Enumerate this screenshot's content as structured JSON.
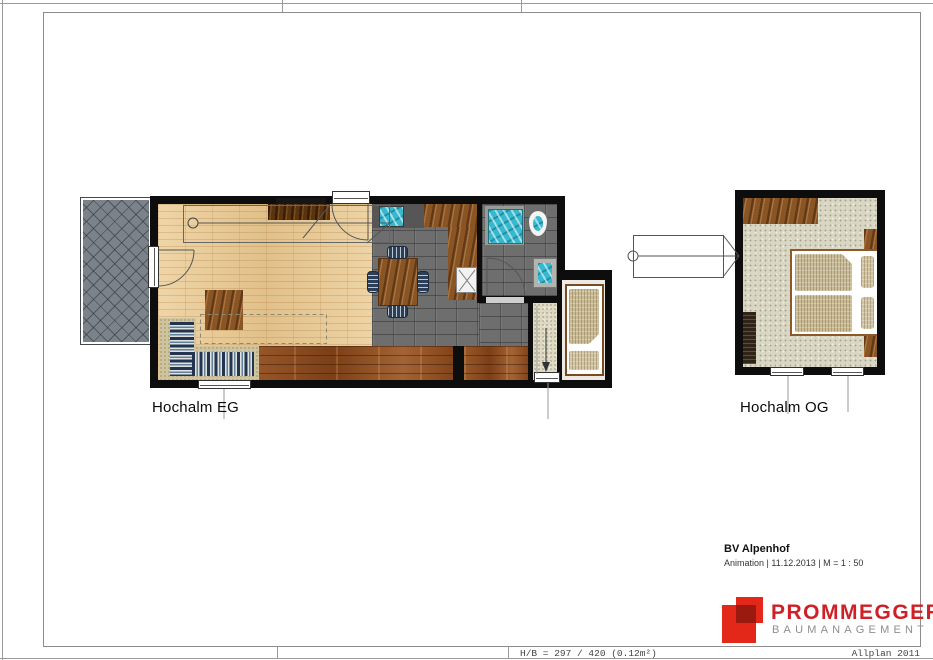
{
  "sheet": {
    "footer": {
      "left": "H/B = 297 / 420 (0.12m²)",
      "right": "Allplan 2011"
    }
  },
  "plans": {
    "eg": {
      "label": "Hochalm EG"
    },
    "og": {
      "label": "Hochalm OG"
    }
  },
  "title_block": {
    "project": "BV Alpenhof",
    "meta": "Animation | 11.12.2013 | M = 1 : 50"
  },
  "logo": {
    "name": "PROMMEGGER",
    "subtitle": "BAUMANAGEMENT",
    "brand_red": "#e32819",
    "brand_overlap_red": "#9a1a10",
    "wordmark_red": "#cf2027",
    "wordmark_gray": "#8d8d8d"
  },
  "palette": {
    "wall_black": "#0d0d0d",
    "parquet_beige": "#e6c794",
    "tile_gray": "#6e6e6e",
    "plank_brown": "#8c4d22",
    "terrace_gray": "#7b8289",
    "carpet_greige": "#d9d7c4",
    "water_teal": "#35b9cf",
    "sofa_navy": "#24344e",
    "frame_gray": "#8c8c8c"
  }
}
